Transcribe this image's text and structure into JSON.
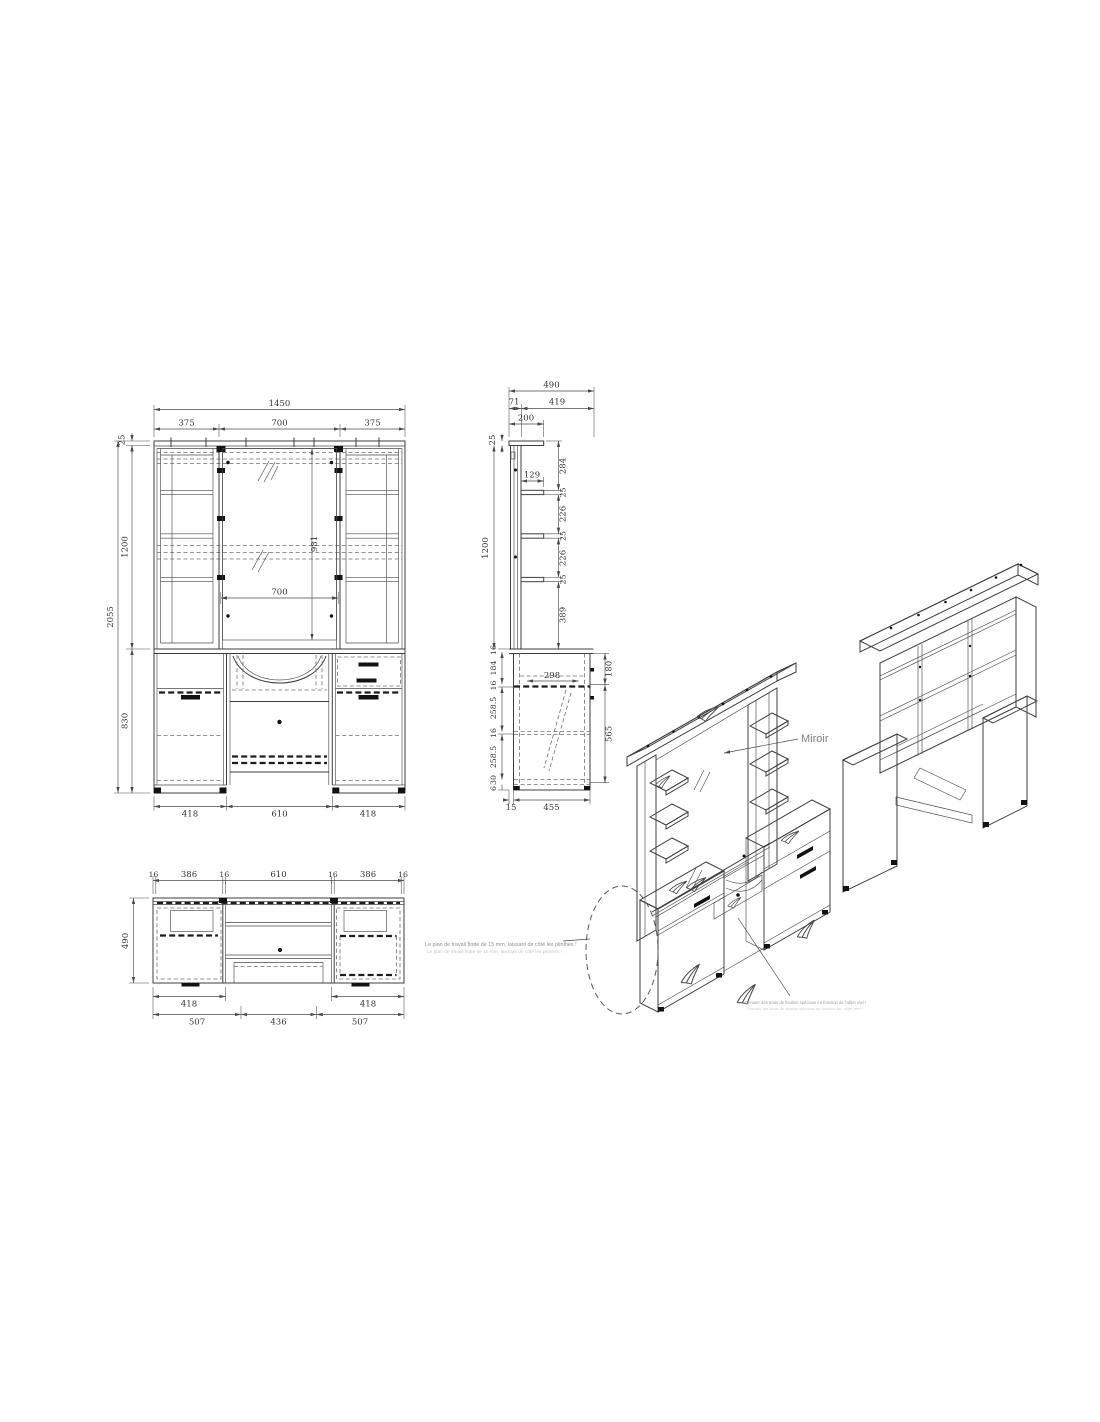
{
  "drawing": {
    "front": {
      "width_total": "1450",
      "segments": [
        "375",
        "700",
        "375"
      ],
      "top_thickness": "25",
      "upper_height": "1200",
      "height_total": "2055",
      "base_height": "830",
      "mirror_height": "981",
      "mirror_width": "700",
      "base_segments": [
        "418",
        "610",
        "418"
      ]
    },
    "side": {
      "depth_total": "490",
      "depth_split": [
        "71",
        "419"
      ],
      "top_shelf_depth": "200",
      "top_thickness": "25",
      "upper_height": "1200",
      "shelf_depth": "129",
      "right_column": [
        "284",
        "25",
        "226",
        "25",
        "226",
        "25",
        "389"
      ],
      "left_column": [
        "16",
        "184",
        "16",
        "258.5",
        "16",
        "258.5",
        "30",
        "6"
      ],
      "inner_width": "298",
      "worktop_drop": "180",
      "base_body": "565",
      "kick": [
        "15",
        "455"
      ]
    },
    "plan": {
      "top_segments": [
        "16",
        "386",
        "16",
        "610",
        "16",
        "386",
        "16"
      ],
      "depth": "490",
      "drawer_widths": [
        "418",
        "418"
      ],
      "bottom_segments": [
        "507",
        "436",
        "507"
      ]
    },
    "iso": {
      "mirror_callout": "Miroir"
    },
    "notes": {
      "worktop_line": "Le plan de travail flotte de 15 mm, laissant de côté les plinthes !",
      "worktop_line_faint": "Le plan de travail flotte de 15 mm, laissant de côté les plinthes !",
      "fixing_line": "Creuser des trous de fixation spéciaux en fonction de l'objet réel !",
      "fixing_line_faint": "Creuser des trous de fixation spéciaux en fonction de l'objet réel !"
    }
  }
}
